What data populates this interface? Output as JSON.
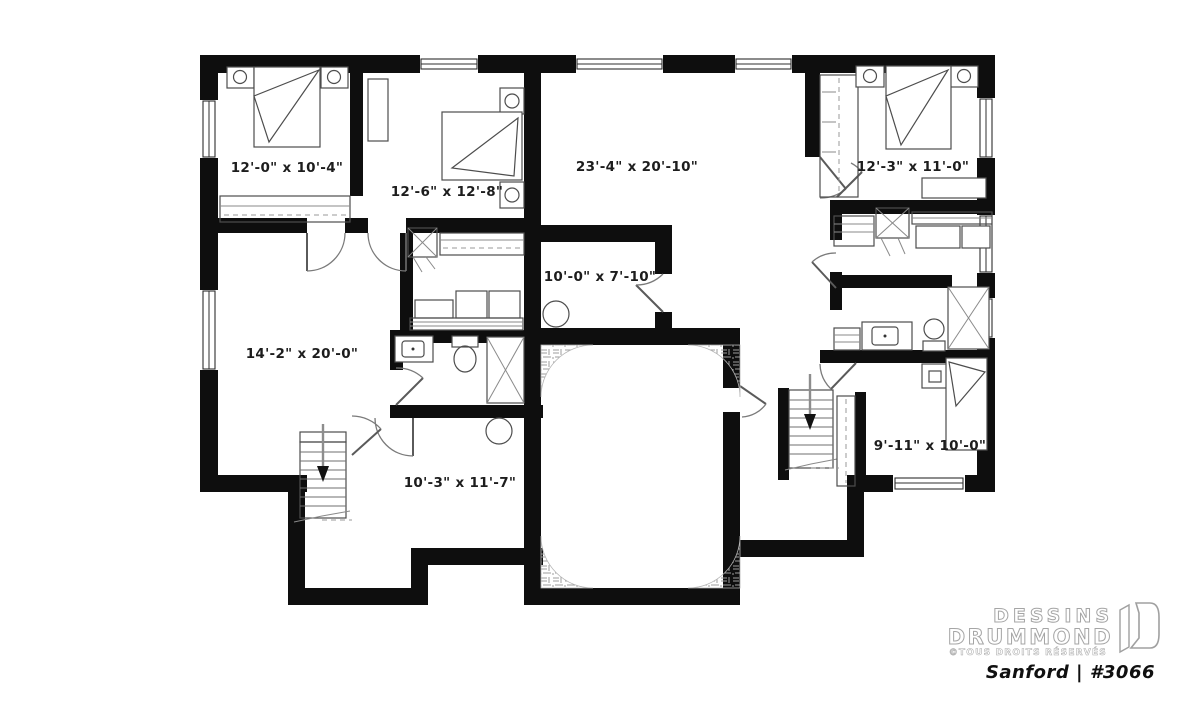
{
  "plan": {
    "rooms": [
      {
        "name": "bedroom-left",
        "dims": "12'-0\" x 10'-4\""
      },
      {
        "name": "bedroom-center",
        "dims": "12'-6\" x 12'-8\""
      },
      {
        "name": "great-room",
        "dims": "23'-4\" x 20'-10\""
      },
      {
        "name": "bedroom-right",
        "dims": "12'-3\" x 11'-0\""
      },
      {
        "name": "utility-room",
        "dims": "10'-0\" x 7'-10\""
      },
      {
        "name": "family-room",
        "dims": "14'-2\" x 20'-0\""
      },
      {
        "name": "rec-room",
        "dims": "10'-3\" x 11'-7\""
      },
      {
        "name": "bedroom-right-lower",
        "dims": "9'-11\" x 10'-0\""
      }
    ],
    "branding": {
      "brand_line1": "DESSINS",
      "brand_line2": "DRUMMOND",
      "rights_notice": "©TOUS DROITS RÉSERVÉS",
      "plan_title": "Sanford | #3066"
    },
    "colors": {
      "wall": "#0e0e0e",
      "label_text": "#1d1d1d",
      "background": "#ffffff"
    }
  }
}
